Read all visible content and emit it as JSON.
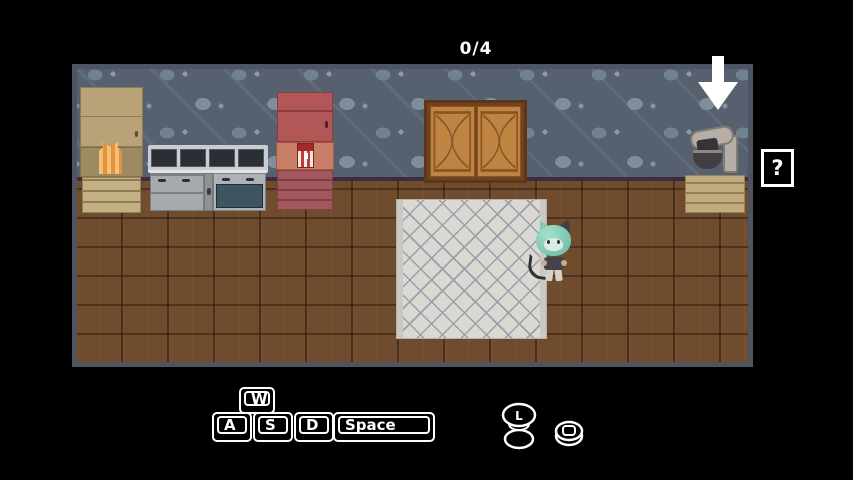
{
  "hud": {
    "task_counter": "0/4",
    "help_button_label": "?"
  },
  "controls": {
    "keys": {
      "w": "W",
      "a": "A",
      "s": "S",
      "d": "D",
      "space": "Space"
    },
    "mouse": {
      "left_button_label": "L"
    }
  },
  "scene": {
    "objects": [
      "pantry-cabinet",
      "grocery-bag",
      "stove-oven",
      "red-cabinet",
      "striped-snack-box",
      "wooden-wall-cabinet",
      "stand-mixer",
      "mixer-counter",
      "down-arrow-indicator",
      "tiled-rug",
      "player-character"
    ],
    "wall_pattern": "fish-and-sparkle-wallpaper",
    "floor_pattern": "wood-plank"
  },
  "colors": {
    "background": "#000000",
    "hud_text": "#ffffff",
    "game_border": "#4e5460",
    "wallpaper_base": "#57606e",
    "floor_wood": "#6f4c2d",
    "rug": "#d9d8d3",
    "cabinet_wood": "#bf8441",
    "red_cabinet": "#b35657",
    "stove_steel": "#c9ccd3",
    "oven_door": "#3d5560",
    "character_hair": "#7fc9b2"
  }
}
